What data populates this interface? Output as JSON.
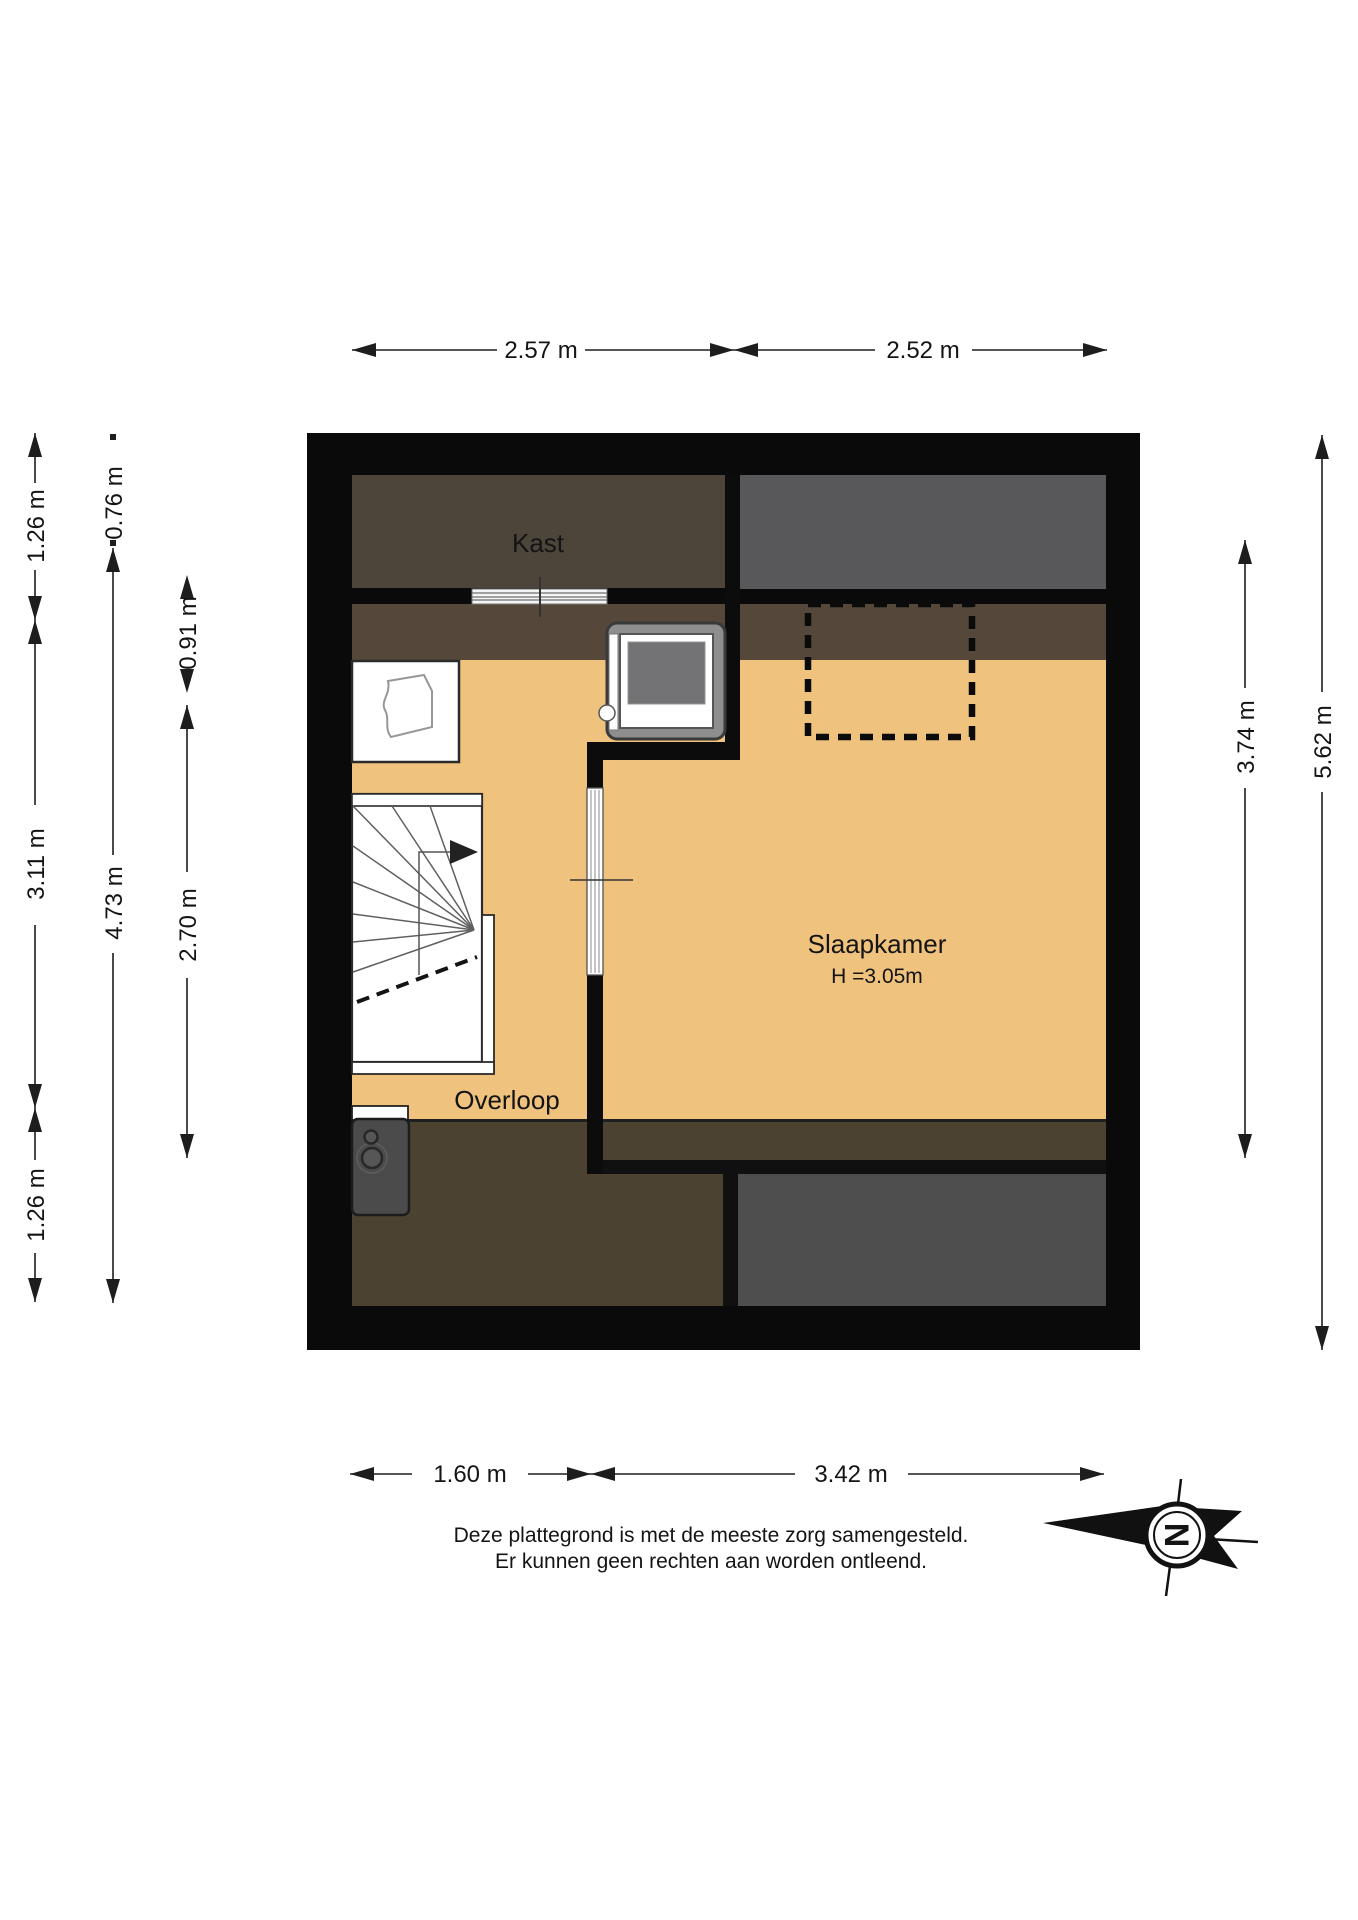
{
  "dims": {
    "top": [
      "2.57 m",
      "2.52 m"
    ],
    "bottom": [
      "1.60 m",
      "3.42 m"
    ],
    "left_outer": [
      "1.26 m",
      "3.11 m",
      "1.26 m"
    ],
    "left_middle": [
      "0.76 m",
      "4.73 m"
    ],
    "left_inner": [
      "0.91 m",
      "2.70 m"
    ],
    "right": [
      "3.74 m",
      "5.62 m"
    ]
  },
  "rooms": {
    "kast": "Kast",
    "slaapkamer": "Slaapkamer",
    "slaapkamer_height": "H =3.05m",
    "overloop": "Overloop"
  },
  "disclaimer": {
    "line1": "Deze plattegrond is met de meeste zorg samengesteld.",
    "line2": "Er kunnen geen rechten aan worden ontleend."
  },
  "compass": {
    "letter": "N"
  },
  "colors": {
    "floor_orange": "#efc27e",
    "kast_brown": "#4d443a",
    "slope_brown": "#55483a",
    "lower_brown": "#4b4231",
    "gray_top_right": "#58585a",
    "gray_bottom_right": "#4e4e4e",
    "wall_black": "#0a0a0a"
  }
}
